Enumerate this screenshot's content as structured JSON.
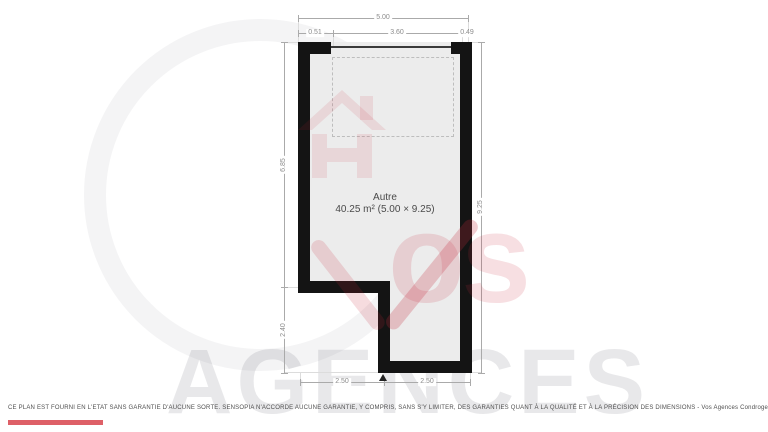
{
  "document": {
    "type": "floor-plan"
  },
  "room": {
    "name": "Autre",
    "area": "40.25 m² (5.00 × 9.25)"
  },
  "dimensions": {
    "top_total": "5.00",
    "top_seg_left": "0.51",
    "top_seg_mid": "3.60",
    "top_seg_right": "0.49",
    "left_upper": "6.85",
    "left_lower": "2.40",
    "right_total": "9.25",
    "bottom_left": "2.50",
    "bottom_right": "2.50"
  },
  "watermark": {
    "word_script": "os",
    "word_block": "AGENCES"
  },
  "footer": {
    "disclaimer": "CE PLAN EST FOURNI EN L'ETAT SANS GARANTIE D'AUCUNE SORTE. SENSOPIA N'ACCORDE AUCUNE GARANTIE, Y COMPRIS, SANS S'Y LIMITER, DES GARANTIES QUANT À LA QUALITÉ ET À LA PRÉCISION DES DIMENSIONS - Vos Agences Condrogest"
  },
  "colors": {
    "wall": "#141414",
    "floor": "#ececec",
    "dimension_text": "#8c8c8c",
    "accent_red": "#d8444c"
  }
}
